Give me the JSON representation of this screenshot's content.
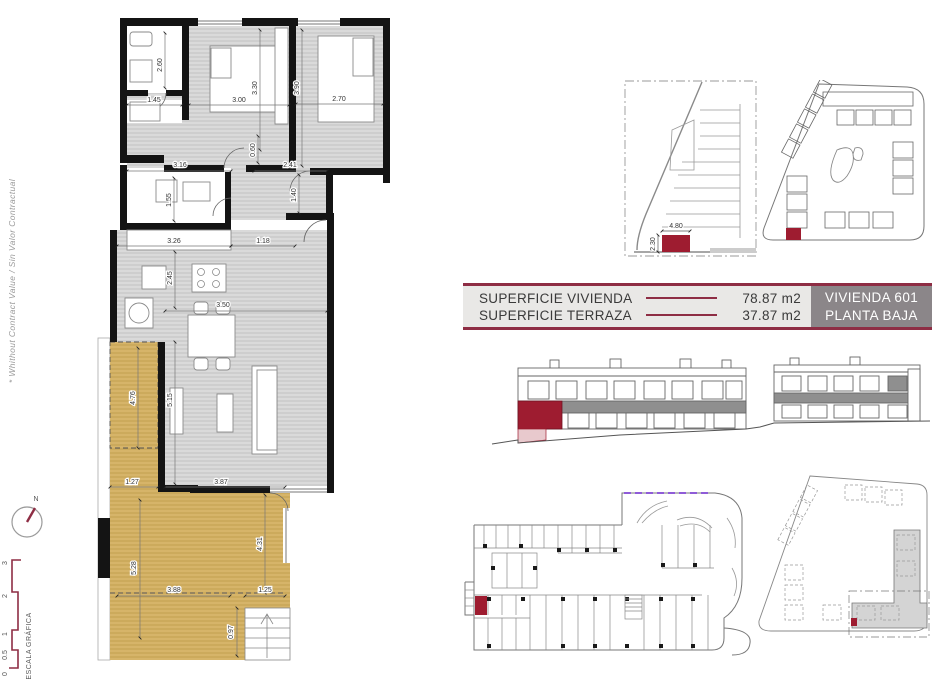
{
  "colors": {
    "maroon_line": "#8e2d44",
    "red_fill": "#9e1c30",
    "unit_box_bg": "#8b8689",
    "table_bg": "#e9e8e6",
    "room_gray": "#d9d9d9",
    "terrace_tan": "#d6b469",
    "purple_dash": "#8f5bd8"
  },
  "side": {
    "disclaimer": "* Whithout Contract Value / Sin Valor Contractual",
    "north_label": "N",
    "scale_label": "ESCALA GRÁFICA",
    "scale_ticks": [
      "0",
      "0.5",
      "1",
      "2",
      "3"
    ]
  },
  "info_table": {
    "rows": [
      {
        "label": "SUPERFICIE VIVIENDA",
        "value": "78.87 m2"
      },
      {
        "label": "SUPERFICIE TERRAZA",
        "value": "37.87 m2"
      }
    ],
    "unit_lines": [
      "VIVIENDA 601",
      "PLANTA BAJA"
    ]
  },
  "floor_plan": {
    "dims": {
      "d260": "2.60",
      "d145": "1.45",
      "d300": "3.00",
      "d330": "3.30",
      "d390": "3.90",
      "d270": "2.70",
      "d060": "0.60",
      "d316": "3.16",
      "d241": "2.41",
      "d140": "1.40",
      "d155": "1.55",
      "d326": "3.26",
      "d118": "1.18",
      "d245": "2.45",
      "d350": "3.50",
      "d515": "5.15",
      "d476": "4.76",
      "d127": "1.27",
      "d387": "3.87",
      "d528": "5.28",
      "d431": "4.31",
      "d388": "3.88",
      "d125": "1.25",
      "d097": "0.97"
    }
  },
  "parking_detail": {
    "dims": {
      "width": "4.80",
      "depth": "2.30"
    }
  }
}
